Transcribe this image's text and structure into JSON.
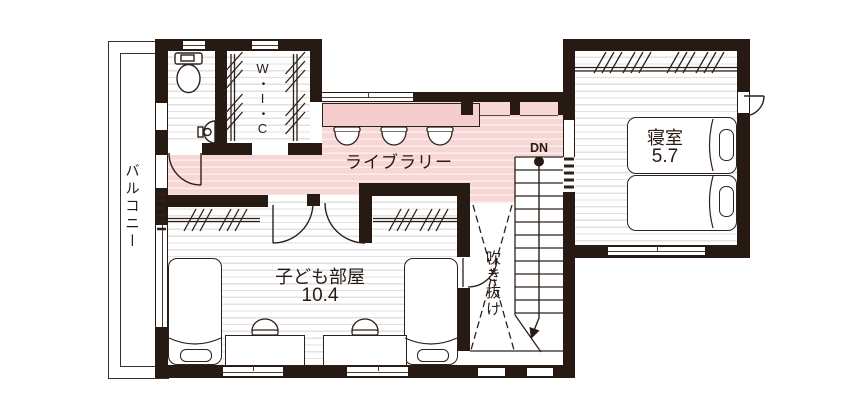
{
  "title": "2F間取り図",
  "colors": {
    "ink": "#271a13",
    "line": "#2c211b",
    "pink": "#f7d7d6",
    "pinkLine": "#fceceb",
    "floorLine": "#e3e1e0",
    "counter": "#f4cdcc"
  },
  "labels": {
    "balcony": "バルコニー",
    "wic": "W・I・C",
    "library": "ライブラリー",
    "bedroom": {
      "name": "寝室",
      "area": "5.7"
    },
    "kids_room": {
      "name": "子ども部屋",
      "area": "10.4"
    },
    "void": "吹き抜け",
    "stairs_down": "DN"
  }
}
